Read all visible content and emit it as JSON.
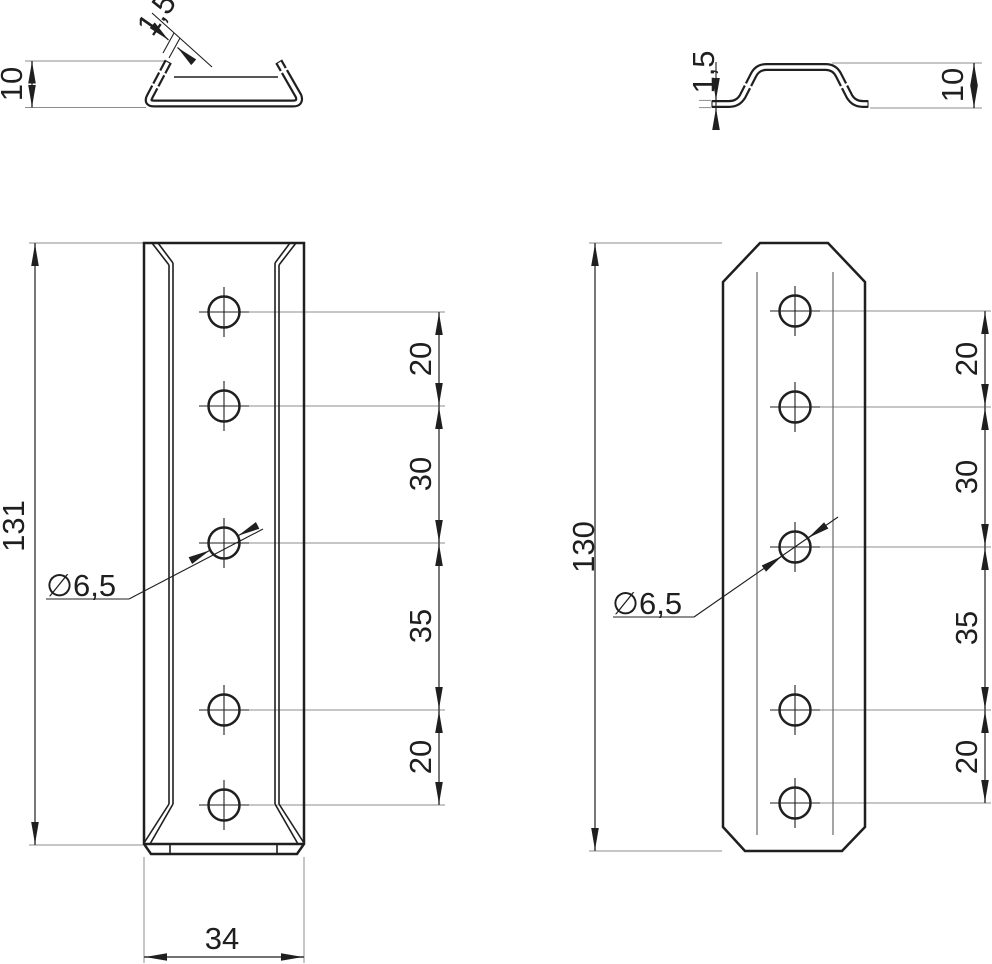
{
  "drawing": {
    "left_profile": {
      "height": "10",
      "thickness": "1,5"
    },
    "right_profile": {
      "height": "10",
      "thickness": "1,5"
    },
    "left_plate": {
      "length": "131",
      "width": "34",
      "hole_diameter": "∅6,5",
      "spacings": [
        "20",
        "30",
        "35",
        "20"
      ]
    },
    "right_plate": {
      "length": "130",
      "hole_diameter": "∅6,5",
      "spacings": [
        "20",
        "30",
        "35",
        "20"
      ]
    },
    "colors": {
      "line": "#1f1f1f",
      "extension_line": "#8c8c8c",
      "background": "#ffffff"
    }
  }
}
